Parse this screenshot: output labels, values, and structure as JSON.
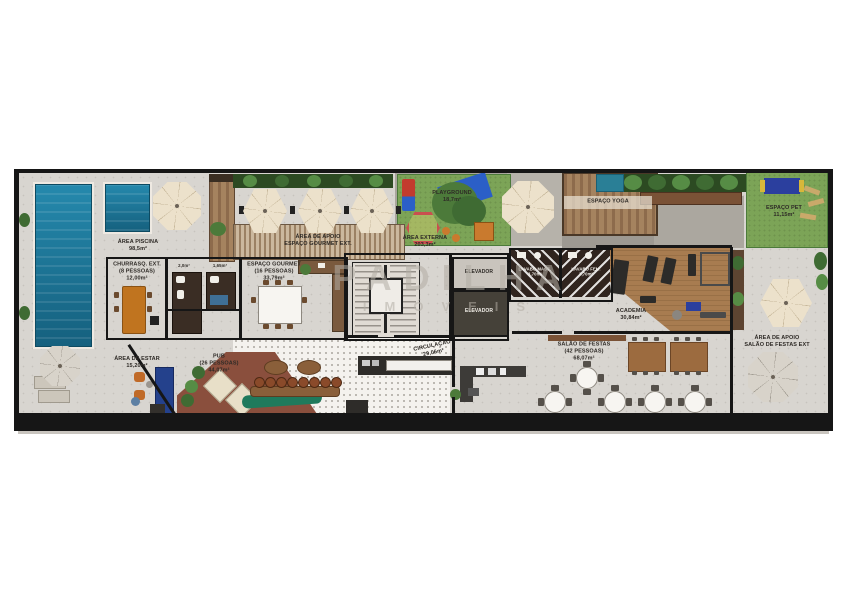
{
  "watermark": {
    "line1": "PADILHA",
    "line2": "IMÓVEIS"
  },
  "rooms": {
    "area_piscina": {
      "name": "ÁREA PISCINA",
      "area": "98,5m²"
    },
    "churrasq_ext": {
      "name": "CHURRASQ. EXT.",
      "capacity": "(8 PESSOAS)",
      "area": "12,00m²"
    },
    "apoio_gourmet": {
      "line1": "ÁREA DE APOIO",
      "line2": "ESPAÇO GOURMET EXT."
    },
    "espaco_gourmet": {
      "name": "ESPAÇO GOURMET",
      "capacity": "(16 PESSOAS)",
      "area": "33,79m²"
    },
    "wc_a": {
      "area": "2,0m²"
    },
    "wc_b": {
      "area": "1,65m²"
    },
    "playground": {
      "name": "PLAYGROUND",
      "area": "18,7m²"
    },
    "area_externa": {
      "name": "ÁREA EXTERNA",
      "area": "203,3m²"
    },
    "espaco_yoga": {
      "name": "ESPAÇO YOGA"
    },
    "espaco_pet": {
      "name": "ESPAÇO PET",
      "area": "11,15m²"
    },
    "elevador_1": {
      "name": "ELEVADOR"
    },
    "elevador_2": {
      "name": "ELEVADOR"
    },
    "circulacao": {
      "name": "CIRCULAÇÃO",
      "area": "29,06m²"
    },
    "lavabo_masc": {
      "name": "LAVABO MASC.",
      "area": "3,70m²"
    },
    "lavabo_fem": {
      "name": "LAVABO FEM.",
      "area": "3,70m²"
    },
    "academia": {
      "name": "ACADEMIA",
      "area": "30,84m²"
    },
    "area_estar": {
      "name": "ÁREA DE ESTAR",
      "area": "15,20m²"
    },
    "pub": {
      "name": "PUB",
      "capacity": "(26 PESSOAS)",
      "area": "44,07m²"
    },
    "salao_festas": {
      "name": "SALÃO DE FESTAS",
      "capacity": "(42 PESSOAS)",
      "area": "68,07m²"
    },
    "apoio_salao": {
      "line1": "ÁREA DE APOIO",
      "line2": "SALÃO DE FESTAS EXT"
    }
  },
  "colors": {
    "pool": "#1e7ba0",
    "grass": "#7ca457",
    "wood_deck": "#93704c",
    "pergola": "#b59b82",
    "bar_counter": "#1f7a5c",
    "terracotta": "#8a4f3d",
    "academia_floor": "#a5794e",
    "wall": "#161616"
  }
}
